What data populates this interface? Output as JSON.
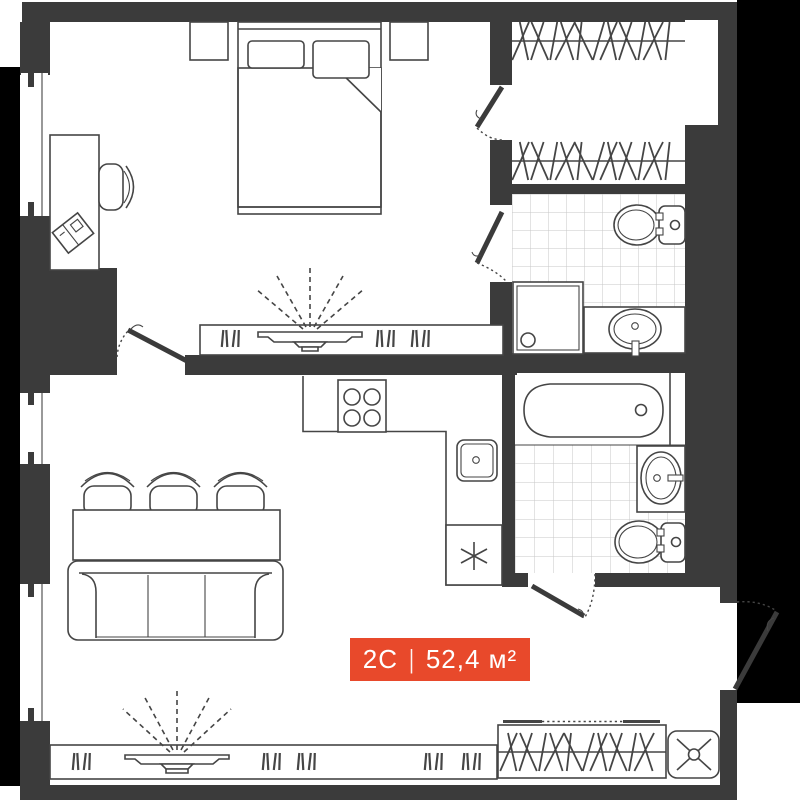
{
  "floorplan": {
    "unit_label": {
      "type": "2С",
      "divider": "|",
      "area": "52,4 м²"
    },
    "colors": {
      "accent": "#e8492b",
      "walls": "#3b3b3b",
      "outside": "#000000",
      "line": "#454545",
      "tile_line": "#c7c7c7"
    },
    "icons": {
      "fridge": "asterisk-snowflake",
      "washing_machine": "cross-circle",
      "tv": "screen-with-projection-rays",
      "wardrobe": "hanger-hatching"
    }
  }
}
